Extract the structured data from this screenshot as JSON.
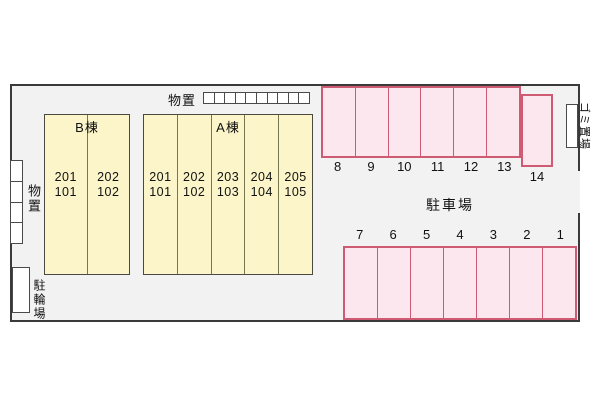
{
  "site_plan": {
    "colors": {
      "site_background": "#f2f2f2",
      "site_border": "#3a3a3a",
      "building_fill": "#fbf5c9",
      "building_border": "#4a4a40",
      "parking_fill": "#fde7ef",
      "parking_border": "#cf5a73",
      "outbuilding_fill": "#ffffff"
    },
    "buildings": {
      "b": {
        "label": "B棟",
        "units": [
          {
            "upper": "201",
            "lower": "101"
          },
          {
            "upper": "202",
            "lower": "102"
          }
        ]
      },
      "a": {
        "label": "A棟",
        "units": [
          {
            "upper": "201",
            "lower": "101"
          },
          {
            "upper": "202",
            "lower": "102"
          },
          {
            "upper": "203",
            "lower": "103"
          },
          {
            "upper": "204",
            "lower": "104"
          },
          {
            "upper": "205",
            "lower": "105"
          }
        ]
      }
    },
    "storage_top": {
      "label": "物置",
      "box_count": 10
    },
    "storage_left": {
      "label": "物置",
      "box_count": 4
    },
    "bicycle_parking": {
      "label": "駐輪場"
    },
    "garbage_area": {
      "label": "ゴミ置場"
    },
    "parking": {
      "label": "駐車場",
      "top_row_numbers": [
        "8",
        "9",
        "10",
        "11",
        "12",
        "13"
      ],
      "offset_spot_number": "14",
      "bottom_row_numbers": [
        "7",
        "6",
        "5",
        "4",
        "3",
        "2",
        "1"
      ]
    }
  }
}
